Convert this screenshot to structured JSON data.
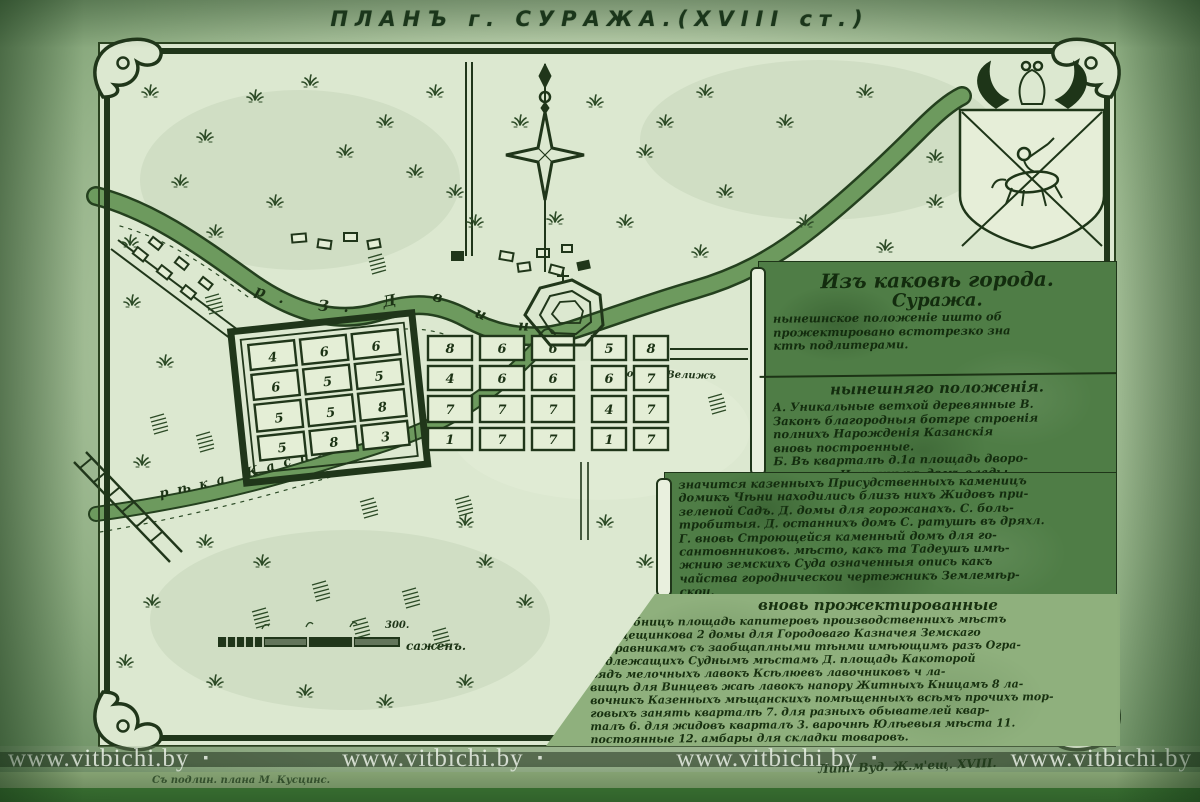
{
  "title": "ПЛАНЪ г. СУРАЖА.(XVIII ст.)",
  "watermark": {
    "items": [
      "www.vitbichi.by",
      "www.vitbichi.by",
      "www.vitbichi.by",
      "www.vitbichi.by"
    ],
    "bullet": "▪"
  },
  "colors": {
    "paper": "#dce8d0",
    "ink": "#1e3518",
    "legend_panel": "#4f7d46",
    "river": "#6d9a5e",
    "bottom_band": "#417e38"
  },
  "map": {
    "river_dvina_label": "р. З. Д в и н а",
    "river_kasplya_label": "рѣка Каспля",
    "road_label": "дорога въ Велижъ",
    "scale_value": "300.",
    "scale_unit": "саженъ.",
    "signature_left": "Съ подлин. плана М. Кусцинс.",
    "signature_right": "Лит. Вуд. Ж.м'ещ. ХVІІІ.",
    "fortress_numbers": [
      "4",
      "6",
      "6",
      "6",
      "5",
      "5",
      "5",
      "5",
      "8",
      "5",
      "8",
      "3"
    ],
    "town_west_numbers": [
      "8",
      "6",
      "6",
      "4",
      "6",
      "6",
      "7",
      "7",
      "7",
      "1",
      "7",
      "7"
    ],
    "town_east_numbers": [
      "5",
      "8",
      "6",
      "7",
      "4",
      "7",
      "1",
      "7"
    ]
  },
  "legend": {
    "panel_a": {
      "lines": [
        "Изъ каковѣ города.",
        "Суража.",
        "нынешнское положеніе ишто об",
        "прожектировано встотрезко зна",
        "ктѣ подлитерами."
      ]
    },
    "panel_b": {
      "header": "нынешняго положенія.",
      "lines": [
        "А. Уникальные ветхой деревянные В.",
        "Законъ благородныя ботгре строенія",
        "полнихъ Нарожденія Казанскія",
        "вновь построенные.",
        "Б. Въ кварталѣ д.1а площадь дворо-",
        "мѣютре Истинныхъ домъ влады."
      ]
    },
    "panel_c": {
      "lines": [
        "значится казенныхъ Присудственныхъ каменицъ",
        "домикъ Чѣни находились близъ нихъ Жидовъ при-",
        "зеленой Садъ. Д. домы для горожанахъ. С. боль-",
        "тробитыя. Д. останнихъ домъ С. ратушѣ въ дряхл.",
        "Г. вновь Строющейся каменный домъ для го-",
        "сантовнниковъ. мѣсто, какъ та Тадеушъ имѣ-",
        "жнию земскихъ Суда означенныя опись какъ",
        "чайства городническои чертежникъ Землемѣр-",
        "скои."
      ]
    },
    "panel_d": {
      "header": "вновь прожектированные",
      "lines": [
        "У. клѣбницъ площадь капитеровъ производственнихъ мѣстъ",
        "Птицещинкова 2 домы для Городоваго Казначея Земскаго",
        "Исправникамъ съ заобщаплными тѣнми имѣющимъ разъ Огра-",
        "подлежащихъ Суднымъ мѣстамъ Д. площадь Какоторой",
        "рядъ мелочныхъ лавокъ Ксѣлюевъ лавочниковъ ч ла-",
        "вищѣ для Винцевъ жаѣ лавокъ напору Житныхъ Кницамъ 8 ла-",
        "вочникъ Казенныхъ мѣщанскихъ помѣщенныхъ всѣмъ прочихъ тор-",
        "говыхъ занять кварталѣ 7. для разныхъ обывателей квар-",
        "талъ 6. для жидовъ кварталъ 3. варочнѣ Юлѣевыя мѣста 11.",
        "постоянные 12. амбары для складки товаровъ."
      ]
    }
  }
}
